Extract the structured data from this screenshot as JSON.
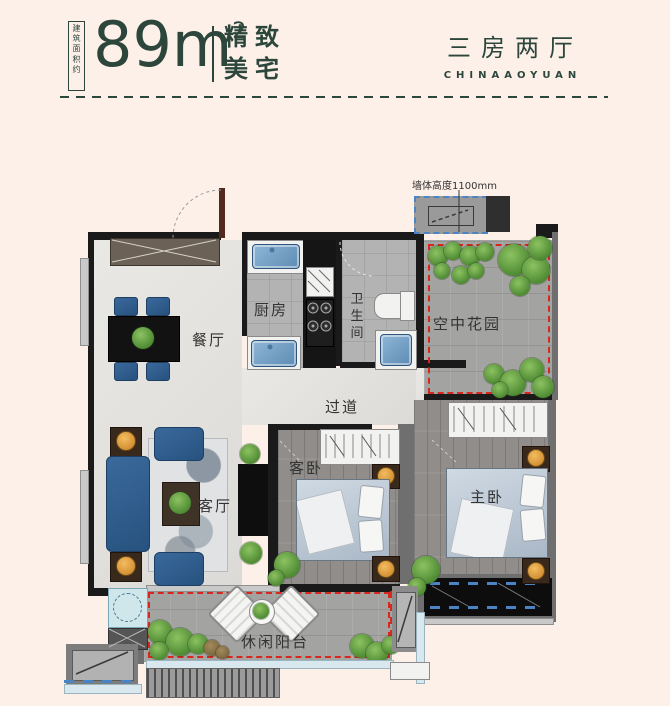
{
  "header": {
    "area_note": "建筑面积约",
    "area_value": "89m",
    "area_sup": "2",
    "tagline_line1": "精致",
    "tagline_line2": "美宅",
    "project_title": "三房两厅",
    "project_subtitle": "CHINAAOYUAN"
  },
  "plan": {
    "annotation_wall_height": "墙体高度1100mm",
    "rooms": {
      "dining": "餐厅",
      "kitchen": "厨房",
      "bathroom": "卫生间",
      "sky_garden": "空中花园",
      "corridor": "过道",
      "living": "客厅",
      "guest_bedroom": "客卧",
      "master_bedroom": "主卧",
      "balcony": "休闲阳台"
    }
  },
  "colors": {
    "background": "#fdf0e8",
    "heading_text": "#2c463c",
    "label_text": "#333333",
    "red_dashed": "#d8281e",
    "blue_dashed": "#4a84c4",
    "furniture_blue": "#2e5c8b",
    "lamp_orange": "#e09b3d",
    "plant_green": "#5f9a3c",
    "wall_dark": "#1a1a1a"
  }
}
